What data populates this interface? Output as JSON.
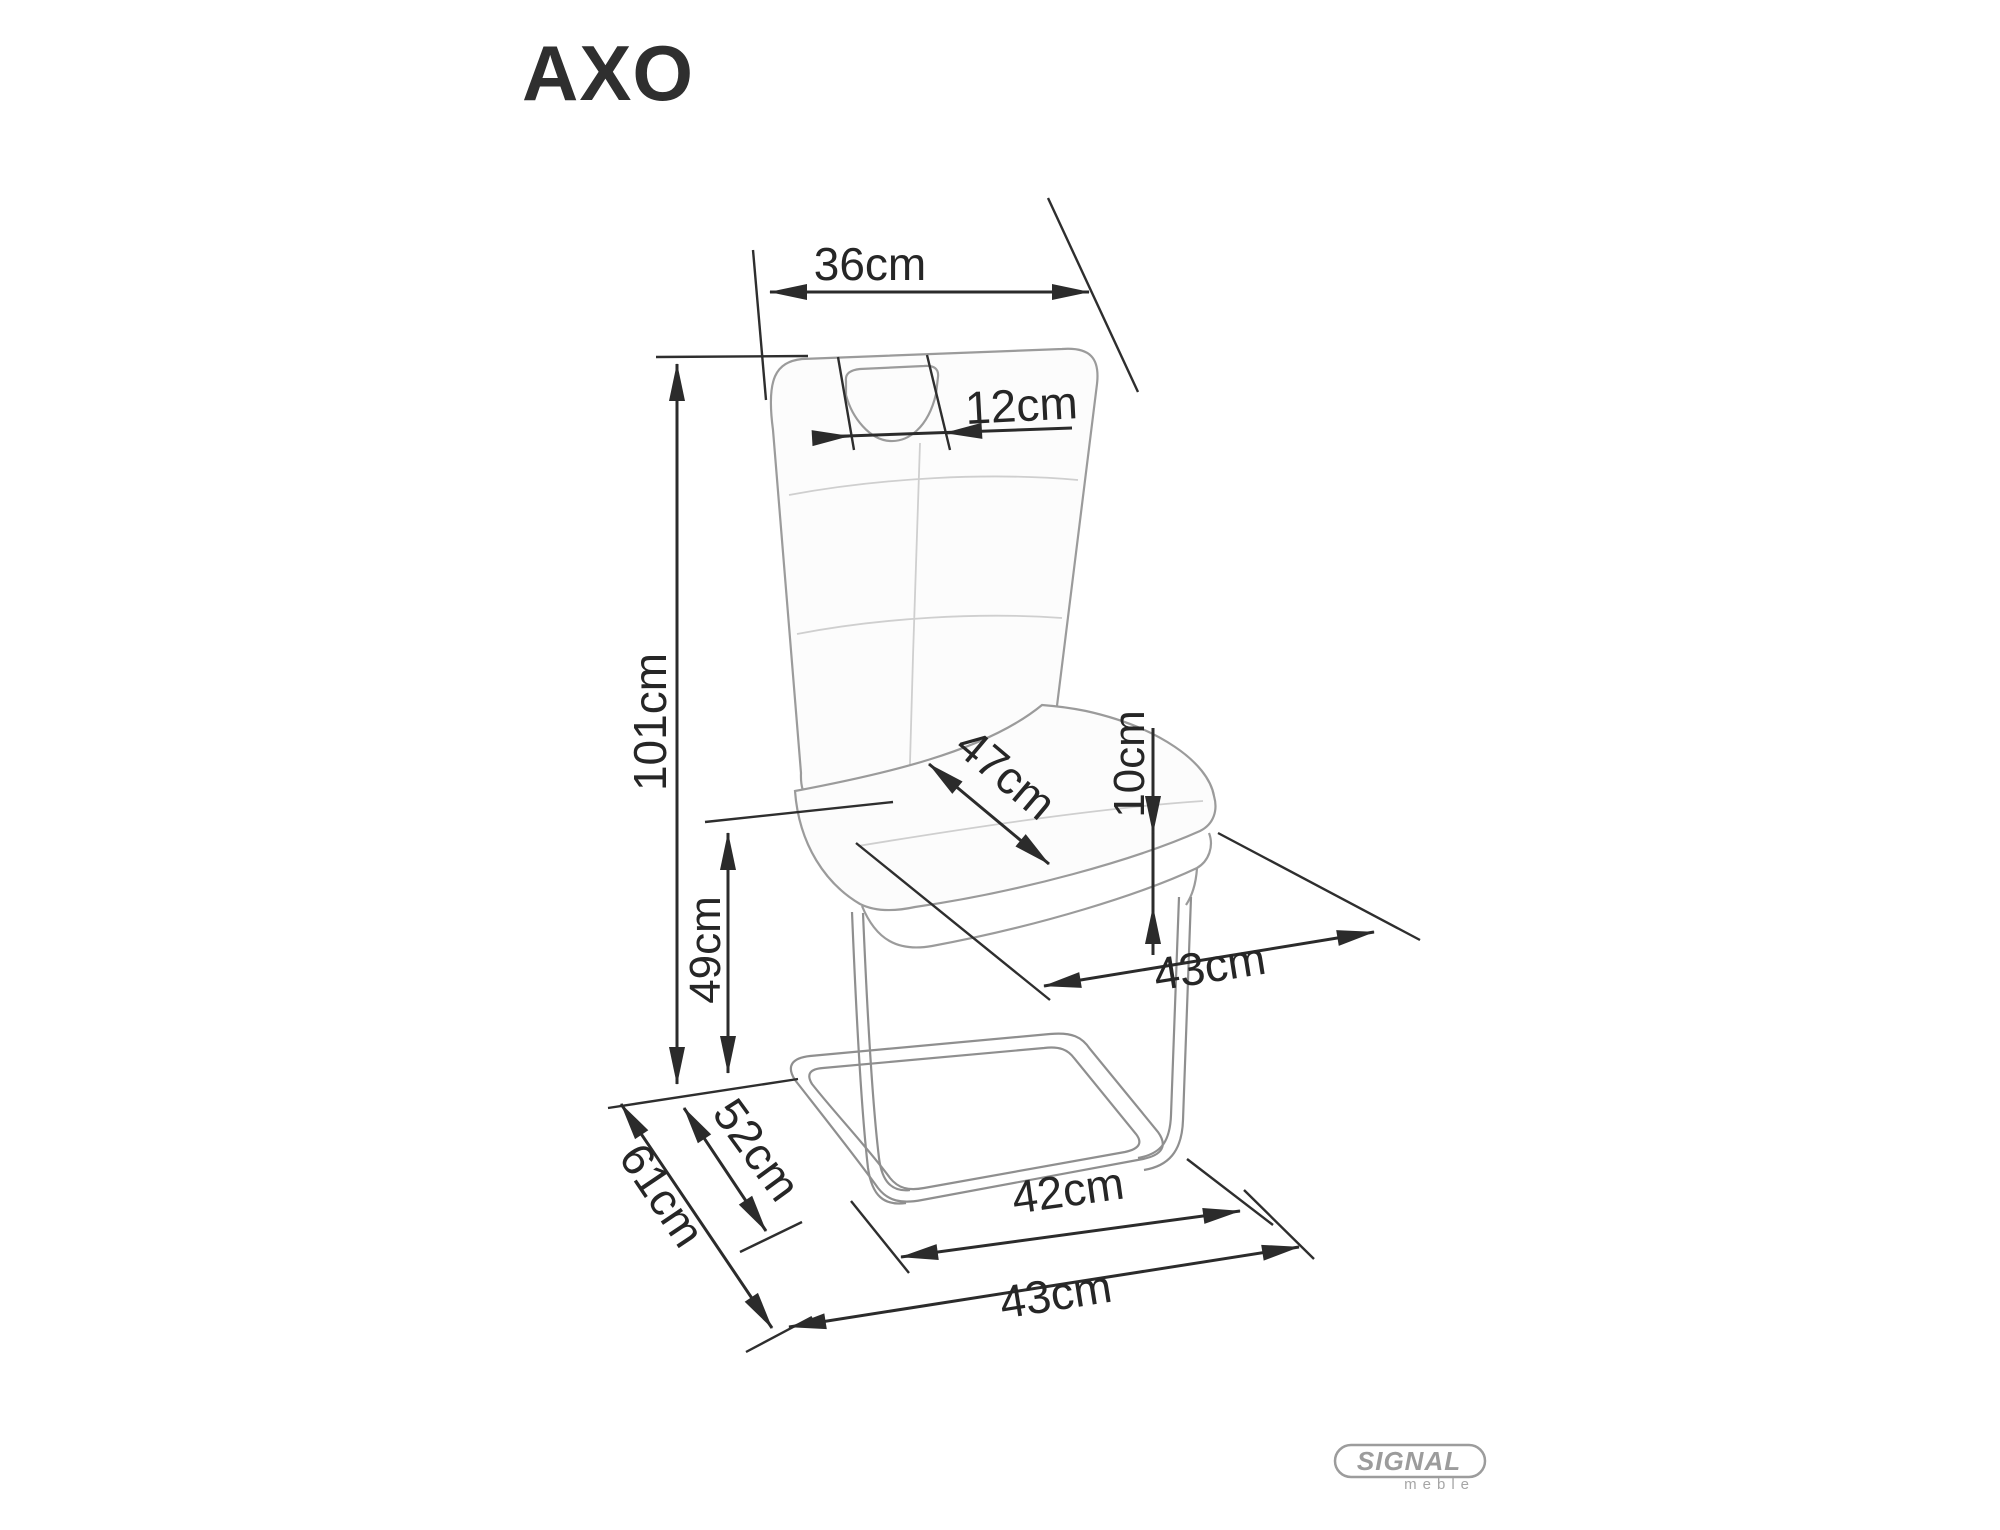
{
  "title": "AXO",
  "dims": {
    "backrest_top_width": "36cm",
    "handle_width": "12cm",
    "total_height": "101cm",
    "seat_depth": "47cm",
    "seat_thickness": "10cm",
    "seat_height": "49cm",
    "seat_width": "43cm",
    "runner_depth": "52cm",
    "total_depth": "61cm",
    "base_inner_width": "42cm",
    "base_outer_width": "43cm"
  },
  "logo": {
    "brand": "SIGNAL",
    "subtitle": "meble"
  },
  "colors": {
    "dimension_line": "#2b2b2b",
    "chair_line": "#9b9b9b",
    "logo_gray": "#9c9c9c",
    "background": "#ffffff"
  }
}
